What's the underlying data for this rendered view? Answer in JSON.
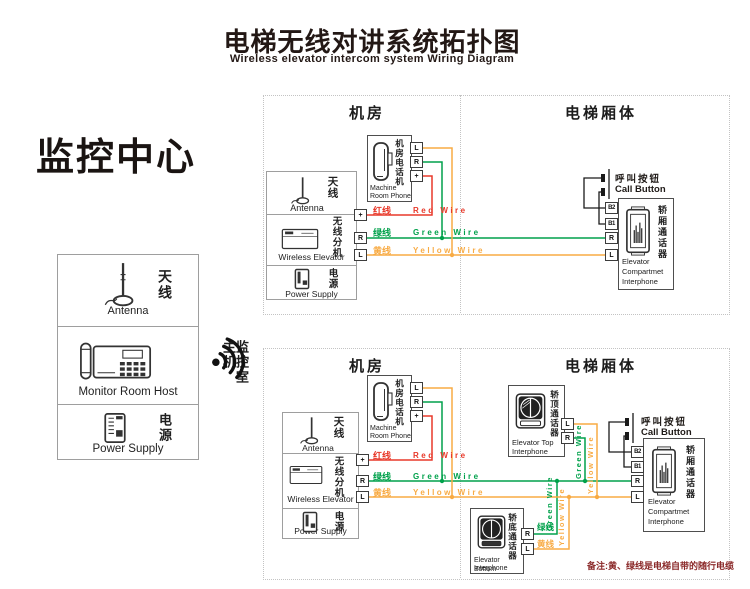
{
  "header": {
    "title_cn": "电梯无线对讲系统拓扑图",
    "title_en": "Wireless elevator intercom system Wiring Diagram"
  },
  "monitor": {
    "title": "监控中心",
    "antenna": {
      "cn": "天线",
      "en": "Antenna"
    },
    "host": {
      "cn": "监控室主机",
      "en": "Monitor Room Host"
    },
    "power": {
      "cn": "电源",
      "en": "Power Supply"
    }
  },
  "sections": {
    "room": "机房",
    "car": "电梯厢体"
  },
  "station": {
    "antenna_cn": "天线",
    "antenna_en": "Antenna",
    "wireless_cn": "无线分机",
    "wireless_en": "Wireless Elevator",
    "power_cn": "电源",
    "power_en": "Power Supply",
    "t_plus": "+",
    "t_r": "R",
    "t_l": "L"
  },
  "phone": {
    "cn": "机房电话机",
    "en1": "Machine",
    "en2": "Room Phone",
    "t_l": "L",
    "t_r": "R",
    "t_plus": "+"
  },
  "wire_labels": {
    "red_cn": "红线",
    "red_en": "Red Wire",
    "green_cn": "绿线",
    "green_en": "Green Wire",
    "yellow_cn": "黄线",
    "yellow_en": "Yellow Wire"
  },
  "call_button": {
    "cn": "呼叫按钮",
    "en": "Call Button"
  },
  "compartment": {
    "cn": "轿厢通话器",
    "en1": "Elevator",
    "en2": "Compartmet",
    "en3": "Interphone",
    "t_b2": "B2",
    "t_b1": "B1",
    "t_r": "R",
    "t_l": "L"
  },
  "top_interphone": {
    "cn": "轿顶通话器",
    "en1": "Elevator Top",
    "en2": "Interphone",
    "t_l": "L",
    "t_r": "R"
  },
  "bottom_interphone": {
    "cn": "轿底通话器",
    "en1": "Elevator Bottom",
    "en2": "Interphone",
    "t_r": "R",
    "t_l": "L"
  },
  "note": "备注:黄、绿线是电梯自带的随行电缆",
  "colors": {
    "red": "#e8392a",
    "green": "#00a14b",
    "yellow": "#f8ab44",
    "black_wire": "#1a1a1a"
  }
}
